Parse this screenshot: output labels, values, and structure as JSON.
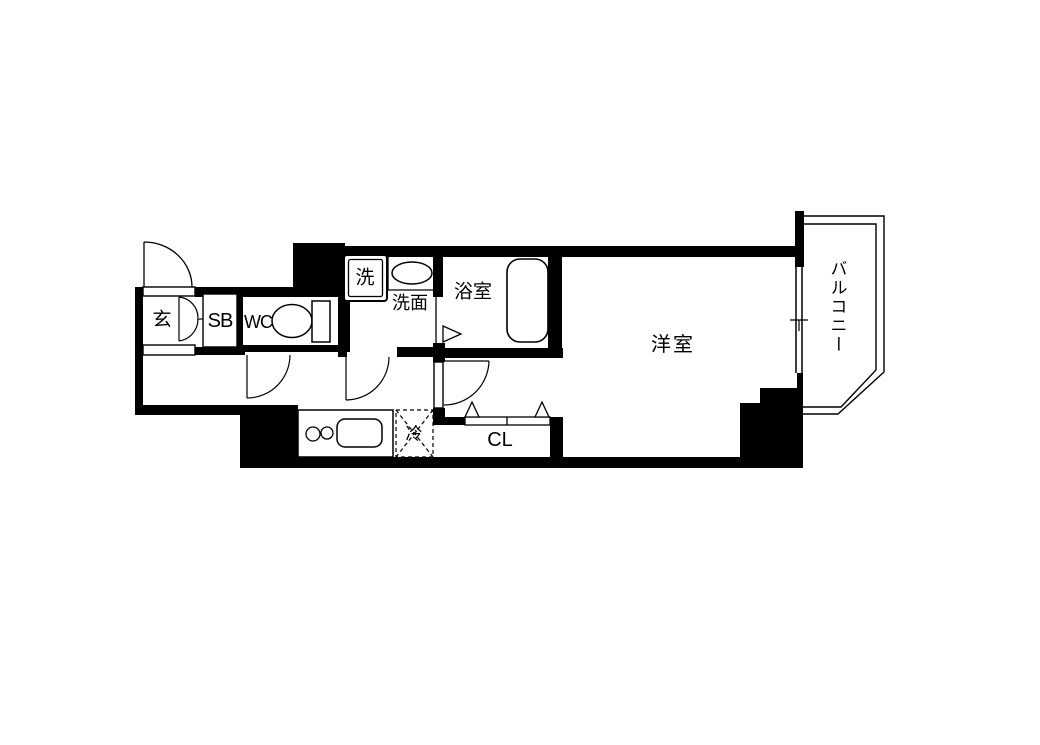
{
  "floorplan": {
    "labels": {
      "genkan": "玄",
      "shoe_box": "SB",
      "toilet": "WC",
      "washing_machine": "洗",
      "washroom": "洗面",
      "bathroom": "浴室",
      "western_room": "洋室",
      "closet": "CL",
      "refrigerator": "冷",
      "balcony": "バルコニー"
    },
    "colors": {
      "wall": "#000000",
      "floor": "#ffffff",
      "line": "#000000"
    }
  }
}
